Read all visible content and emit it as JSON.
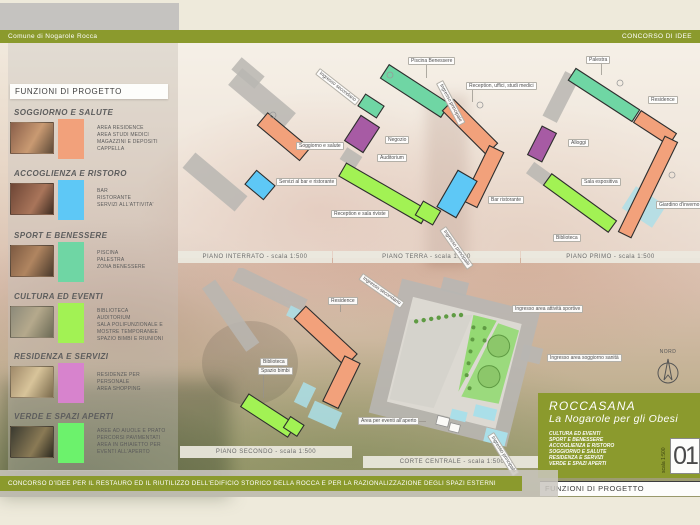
{
  "header": {
    "left_label": "Comune di Nogarole Rocca",
    "right_label": "CONCORSO DI IDEE"
  },
  "sidebar": {
    "title": "FUNZIONI DI PROGETTO",
    "sections": [
      {
        "title": "SOGGIORNO E SALUTE",
        "color": "#f2a17b",
        "items": [
          "AREA RESIDENCE",
          "AREA STUDI MEDICI",
          "MAGAZZINI E DEPOSITI",
          "CAPPELLA"
        ]
      },
      {
        "title": "ACCOGLIENZA E RISTORO",
        "color": "#5ec8f6",
        "items": [
          "BAR",
          "RISTORANTE",
          "SERVIZI ALL'ATTIVITA'"
        ]
      },
      {
        "title": "SPORT E BENESSERE",
        "color": "#6fd6a4",
        "items": [
          "PISCINA",
          "PALESTRA",
          "ZONA BENESSERE"
        ]
      },
      {
        "title": "CULTURA ED EVENTI",
        "color": "#a2f254",
        "items": [
          "BIBLIOTECA",
          "AUDITORIUM",
          "SALA POLIFUNZIONALE E MOSTRE TEMPORANEE",
          "SPAZIO BIMBI E RIUNIONI"
        ]
      },
      {
        "title": "RESIDENZA E SERVIZI",
        "color": "#d783cd",
        "items": [
          "RESIDENZE PER PERSONALE",
          "AREA SHOPPING"
        ]
      },
      {
        "title": "VERDE E SPAZI APERTI",
        "color": "#6cf26c",
        "items": [
          "AREE AD AIUOLE E PRATO",
          "PERCORSI PAVIMENTATI",
          "AREA IN GHIAIETTO PER EVENTI ALL'APERTO"
        ]
      }
    ]
  },
  "plans": [
    {
      "caption": "PIANO INTERRATO - scala 1:500",
      "labels": [
        {
          "text": "Soggiorno e salute"
        },
        {
          "text": "Servizi al bar e ristorante"
        }
      ]
    },
    {
      "caption": "PIANO TERRA - scala 1:500",
      "labels": [
        {
          "text": "Ingresso secondario"
        },
        {
          "text": "Ingresso principale"
        },
        {
          "text": "Piscina  Benessere"
        },
        {
          "text": "Reception, uffici, studi medici"
        },
        {
          "text": "Negozio"
        },
        {
          "text": "Auditorium"
        },
        {
          "text": "Reception e sala riviste"
        },
        {
          "text": "Bar ristorante"
        },
        {
          "text": "Ingresso principale"
        }
      ]
    },
    {
      "caption": "PIANO PRIMO - scala 1:500",
      "labels": [
        {
          "text": "Palestra"
        },
        {
          "text": "Residence"
        },
        {
          "text": "Alloggi"
        },
        {
          "text": "Sala espositiva"
        },
        {
          "text": "Giardino d'inverno"
        },
        {
          "text": "Biblioteca"
        }
      ]
    },
    {
      "caption": "PIANO SECONDO - scala 1:500",
      "labels": [
        {
          "text": "Residence"
        },
        {
          "text": "Biblioteca"
        },
        {
          "text": "Spazio bimbi"
        }
      ]
    },
    {
      "caption": "CORTE CENTRALE - scala 1:500",
      "labels": [
        {
          "text": "Ingresso secondario"
        },
        {
          "text": "Ingresso area attività sportive"
        },
        {
          "text": "Ingresso area soggiorno sanità"
        },
        {
          "text": "Area per eventi all'aperto"
        },
        {
          "text": "Ingresso principale"
        }
      ]
    }
  ],
  "north": {
    "label": "NORD"
  },
  "title_block": {
    "project_name": "ROCCASANA",
    "subtitle": "La Nogarole per gli Obesi",
    "functions": [
      "CULTURA ED EVENTI",
      "SPORT E BENESSERE",
      "ACCOGLIENZA E RISTORO",
      "SOGGIORNO E SALUTE",
      "RESIDENZA E SERVIZI",
      "VERDE E SPAZI APERTI"
    ],
    "sheet_number": "01",
    "sheet_scale": "scala 1:500",
    "panel_label": "FUNZIONI DI PROGETTO"
  },
  "footer": {
    "text": "CONCORSO D'IDEE PER IL RESTAURO ED IL RIUTILIZZO DELL'EDIFICIO STORICO DELLA ROCCA E PER LA RAZIONALIZZAZIONE DEGLI SPAZI ESTERNI"
  },
  "colors": {
    "olive": "#8b9a2d",
    "salmon": "#f2a17b",
    "blue": "#5ec8f6",
    "teal": "#6fd6a4",
    "bright_green": "#a2f254",
    "purple": "#a75ba4",
    "pink": "#d783cd",
    "verde": "#6cf26c",
    "cyan": "#aadfe9",
    "grass": "#8fd96e",
    "plan_gray": "#b8b6b2"
  }
}
